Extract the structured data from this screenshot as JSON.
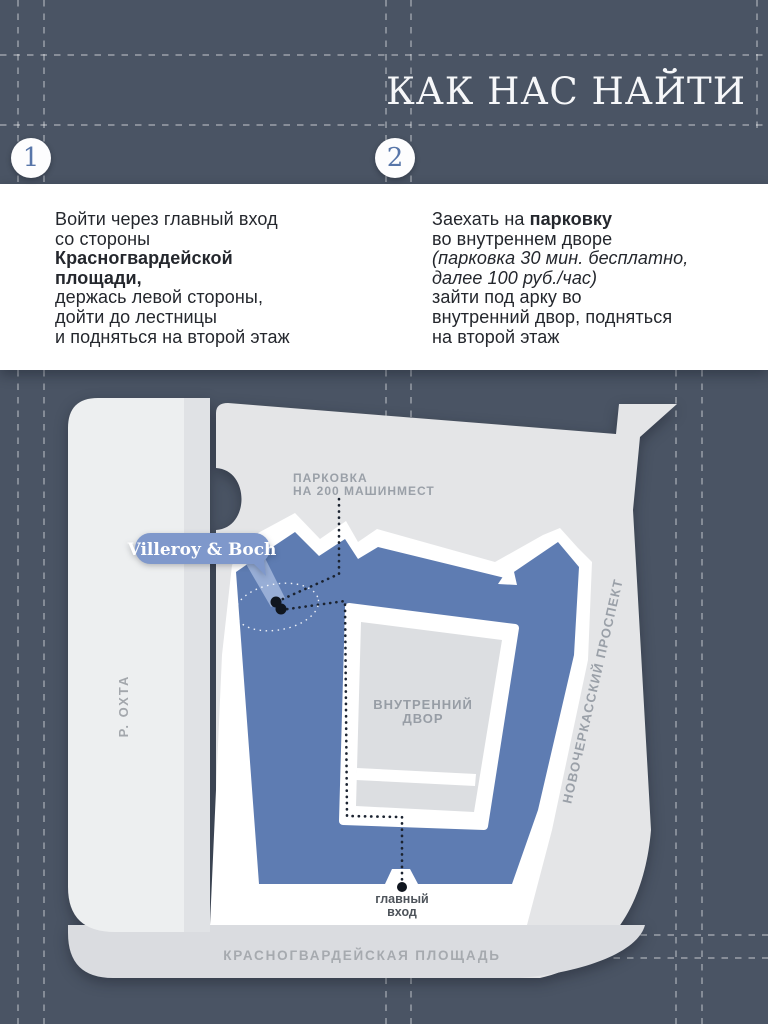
{
  "header": {
    "title": "КАК НАС НАЙТИ"
  },
  "steps": [
    {
      "number": "1",
      "l1": "Войти через главный вход",
      "l2": "со стороны",
      "l3": "Красногвардейской",
      "l4": "площади,",
      "l5": "держась левой стороны,",
      "l6": "дойти до лестницы",
      "l7": "и подняться на второй этаж"
    },
    {
      "number": "2",
      "l1_pre": "Заехать на ",
      "l1_bold": "парковку",
      "l2": "во внутреннем дворе",
      "l3": "(парковка 30 мин. бесплатно,",
      "l4": "далее 100 руб./час)",
      "l5": "зайти под арку во",
      "l6": "внутренний двор, подняться",
      "l7": "на второй этаж"
    }
  ],
  "map": {
    "brand_label": "Villeroy & Boch",
    "parking_line1": "ПАРКОВКА",
    "parking_line2": "НА 200 МАШИНМЕСТ",
    "courtyard_line1": "ВНУТРЕННИЙ",
    "courtyard_line2": "ДВОР",
    "entrance_line1": "главный",
    "entrance_line2": "вход",
    "street_left": "Р. ОХТА",
    "street_right": "НОВОЧЕРКАССКИЙ ПРОСПЕКТ",
    "street_bottom": "КРАСНОГВАРДЕЙСКАЯ ПЛОЩАДЬ"
  },
  "colors": {
    "background": "#4a5464",
    "panel": "#ffffff",
    "building_blue": "#5e7cb2",
    "brand_pill_blue": "#7f98cb",
    "badge_number_blue": "#5876a9",
    "body_text": "#24272d",
    "map_gray": "#e4e5e7",
    "plaza_gray": "#dadce0",
    "map_label_gray": "#9aa0a8"
  }
}
